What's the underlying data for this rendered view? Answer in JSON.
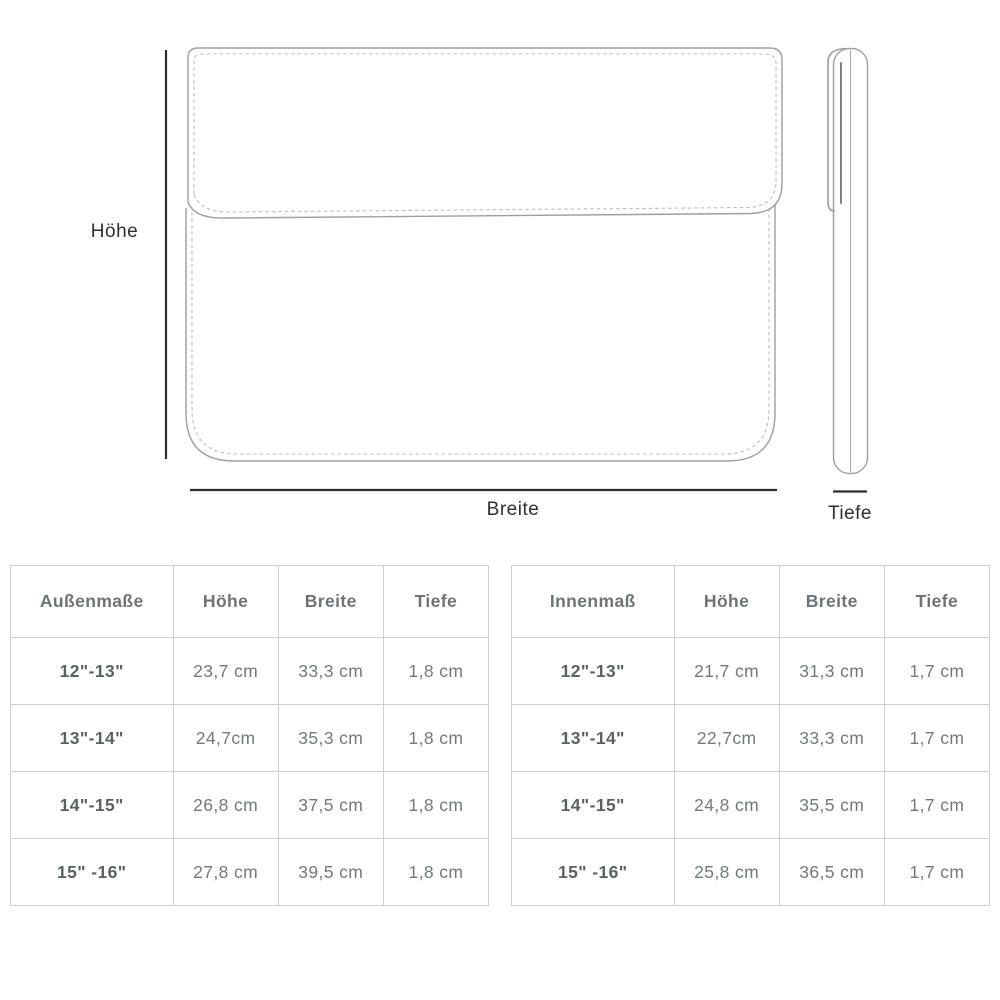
{
  "diagram": {
    "labels": {
      "height": "Höhe",
      "width": "Breite",
      "depth": "Tiefe"
    },
    "colors": {
      "measure_line": "#2d2d2d",
      "sketch_line": "#9e9e9e",
      "stitch_line": "#bcbcbc"
    }
  },
  "tables": [
    {
      "headers": [
        "Außenmaße",
        "Höhe",
        "Breite",
        "Tiefe"
      ],
      "rows": [
        {
          "size": "12\"-13\"",
          "values": [
            "23,7 cm",
            "33,3 cm",
            "1,8 cm"
          ]
        },
        {
          "size": "13\"-14\"",
          "values": [
            "24,7cm",
            "35,3 cm",
            "1,8 cm"
          ]
        },
        {
          "size": "14\"-15\"",
          "values": [
            "26,8 cm",
            "37,5 cm",
            "1,8 cm"
          ]
        },
        {
          "size": "15\" -16\"",
          "values": [
            "27,8 cm",
            "39,5 cm",
            "1,8 cm"
          ]
        }
      ]
    },
    {
      "headers": [
        "Innenmaß",
        "Höhe",
        "Breite",
        "Tiefe"
      ],
      "rows": [
        {
          "size": "12\"-13\"",
          "values": [
            "21,7 cm",
            "31,3 cm",
            "1,7 cm"
          ]
        },
        {
          "size": "13\"-14\"",
          "values": [
            "22,7cm",
            "33,3 cm",
            "1,7 cm"
          ]
        },
        {
          "size": "14\"-15\"",
          "values": [
            "24,8 cm",
            "35,5 cm",
            "1,7 cm"
          ]
        },
        {
          "size": "15\" -16\"",
          "values": [
            "25,8 cm",
            "36,5 cm",
            "1,7 cm"
          ]
        }
      ]
    }
  ]
}
